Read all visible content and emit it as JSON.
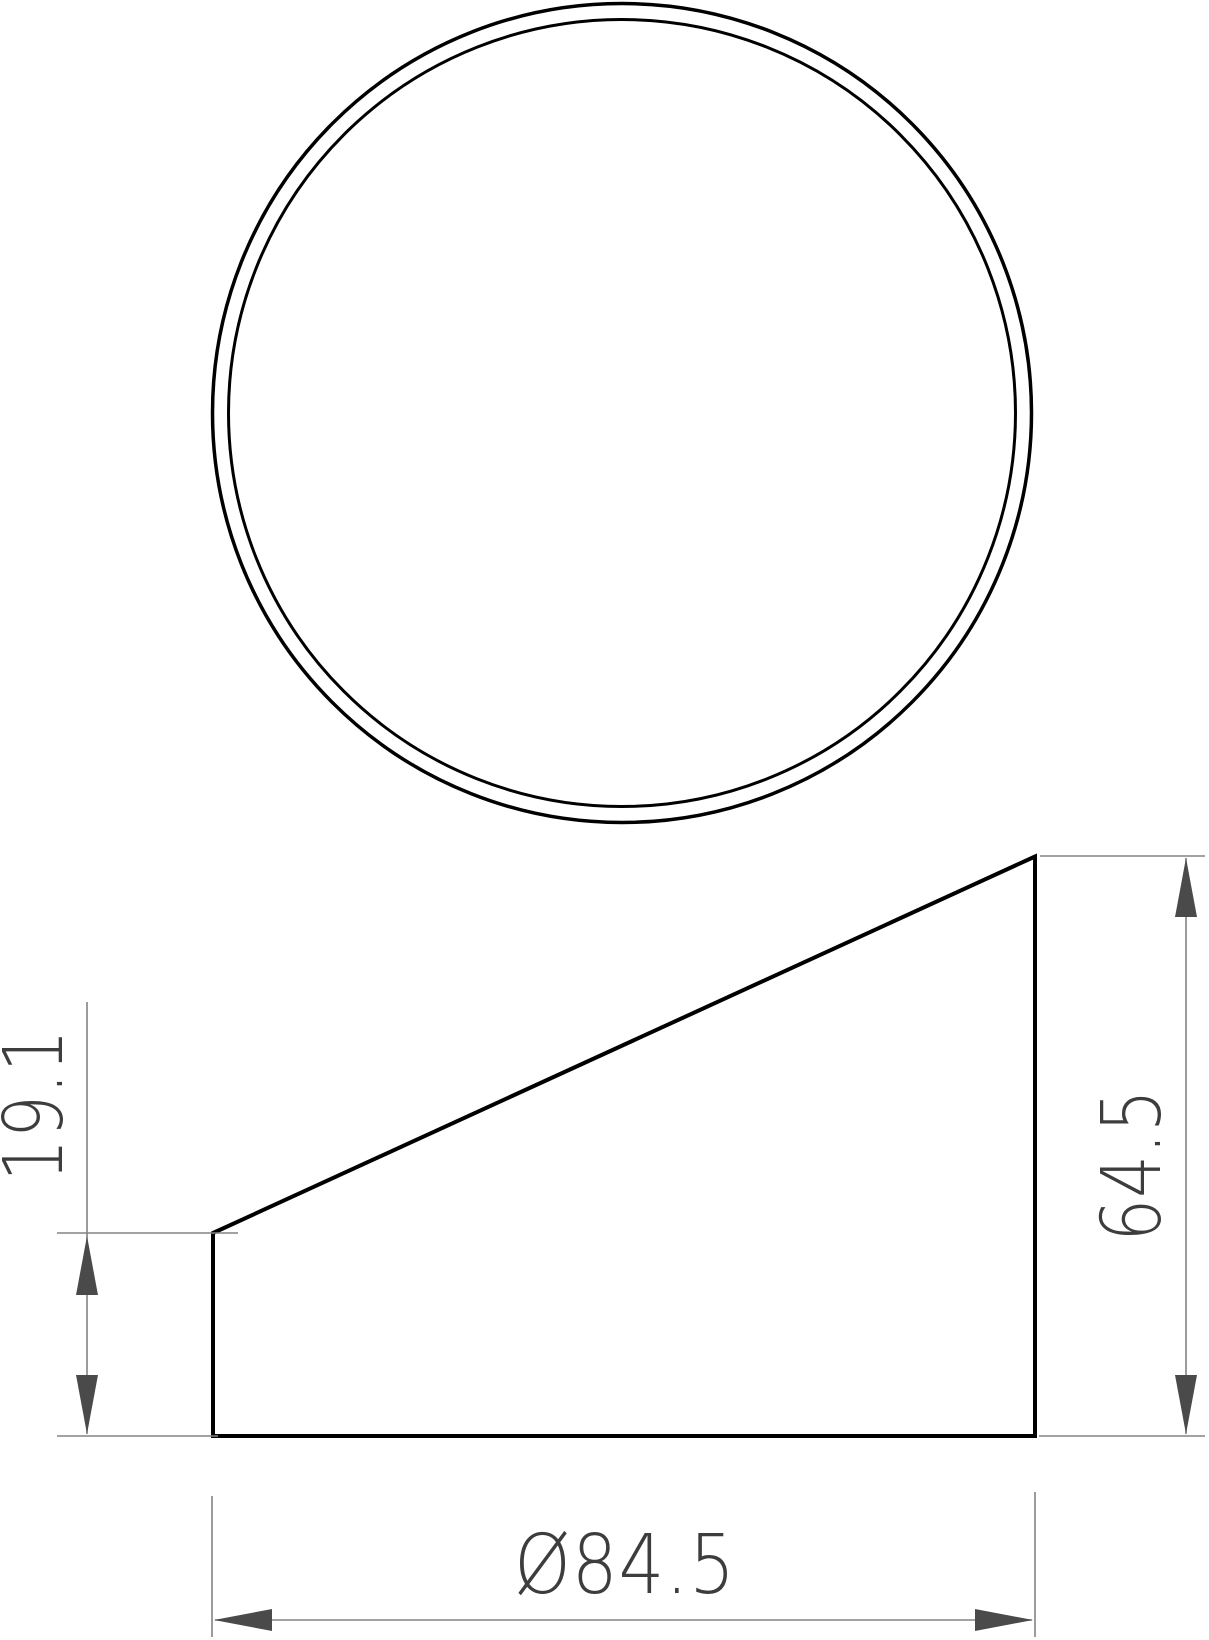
{
  "drawing": {
    "kind": "technical-drawing-two-views",
    "background": "#ffffff",
    "colors": {
      "part_line": "#000000",
      "dimension_line": "#848484",
      "arrow": "#4a4a4a",
      "text": "#3d3d3d"
    },
    "views": {
      "top_view": {
        "description": "two concentric circles"
      },
      "side_view": {
        "description": "wedge profile with slanted top edge"
      }
    },
    "dimensions": {
      "left_height": {
        "label": "19.1"
      },
      "right_height": {
        "label": "64.5"
      },
      "diameter": {
        "label": "Ø84.5"
      }
    }
  }
}
